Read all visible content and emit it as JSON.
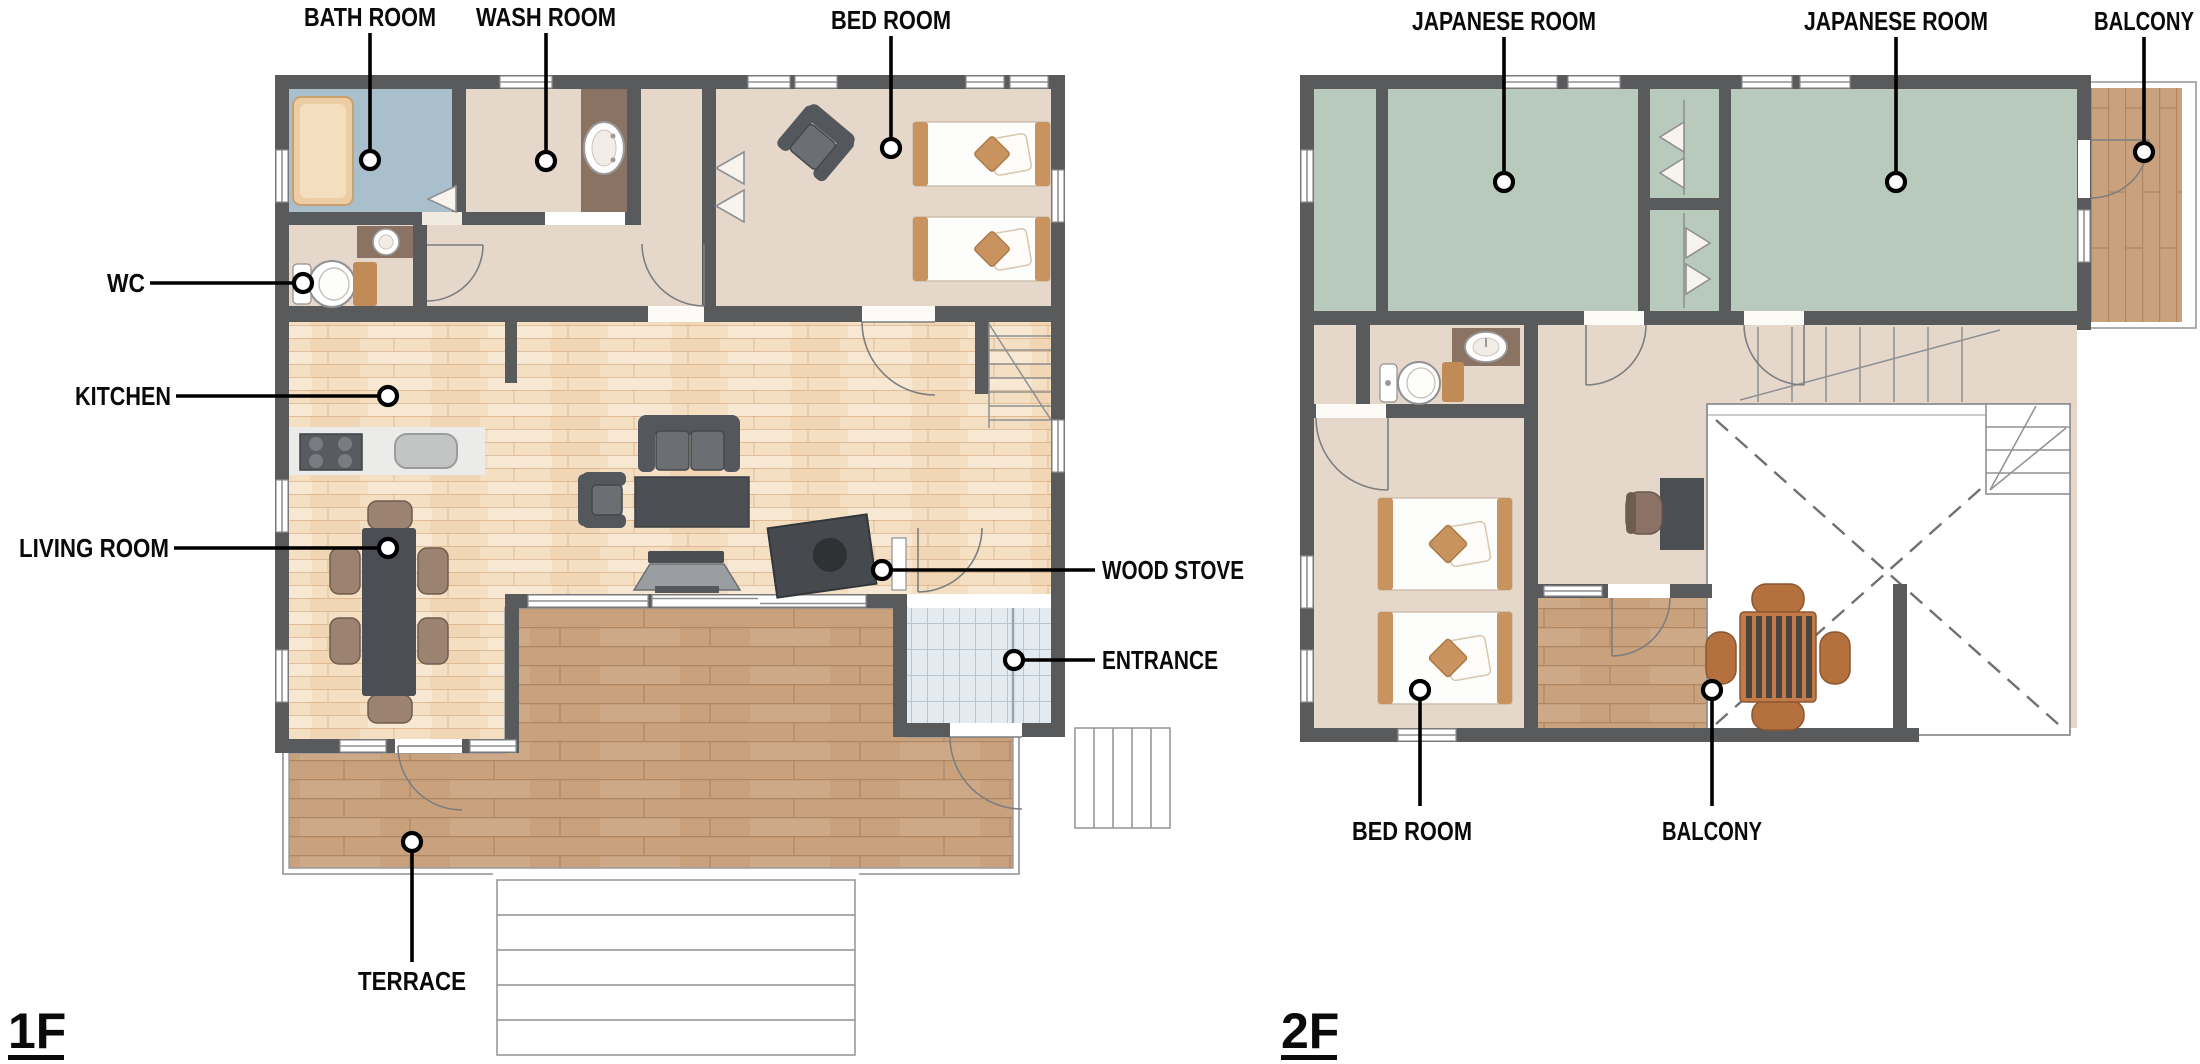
{
  "doc": {
    "type": "floor-plan"
  },
  "f1": {
    "name": "1F",
    "labels": {
      "bath_room": "BATH ROOM",
      "wash_room": "WASH ROOM",
      "bed_room": "BED ROOM",
      "wc": "WC",
      "kitchen": "KITCHEN",
      "living_room": "LIVING ROOM",
      "wood_stove": "WOOD STOVE",
      "entrance": "ENTRANCE",
      "terrace": "TERRACE"
    }
  },
  "f2": {
    "name": "2F",
    "labels": {
      "japanese_room_left": "JAPANESE ROOM",
      "japanese_room_right": "JAPANESE ROOM",
      "balcony_upper": "BALCONY",
      "bed_room": "BED ROOM",
      "balcony_lower": "BALCONY"
    }
  },
  "colors": {
    "wall": "#595a5c",
    "room_tan": "#e5d8cb",
    "bath_blue": "#a9bfcc",
    "tatami_green": "#b8cabc",
    "wood_base": "#f4dfc2",
    "wood_line": "#cf9f73",
    "terrace_base": "#c9a27d",
    "terrace_line": "#a77f5a",
    "tile_base": "#e3eaf0",
    "tile_line": "#b9c5ce",
    "counter_brown": "#8b7363",
    "cabinet_tan": "#c08b57",
    "bed_accent": "#c9935f",
    "furniture_dark": "#4b4e53",
    "furniture_mid": "#6b6e73",
    "chair_brown": "#9c8270",
    "balcony_chair": "#b4713e"
  }
}
